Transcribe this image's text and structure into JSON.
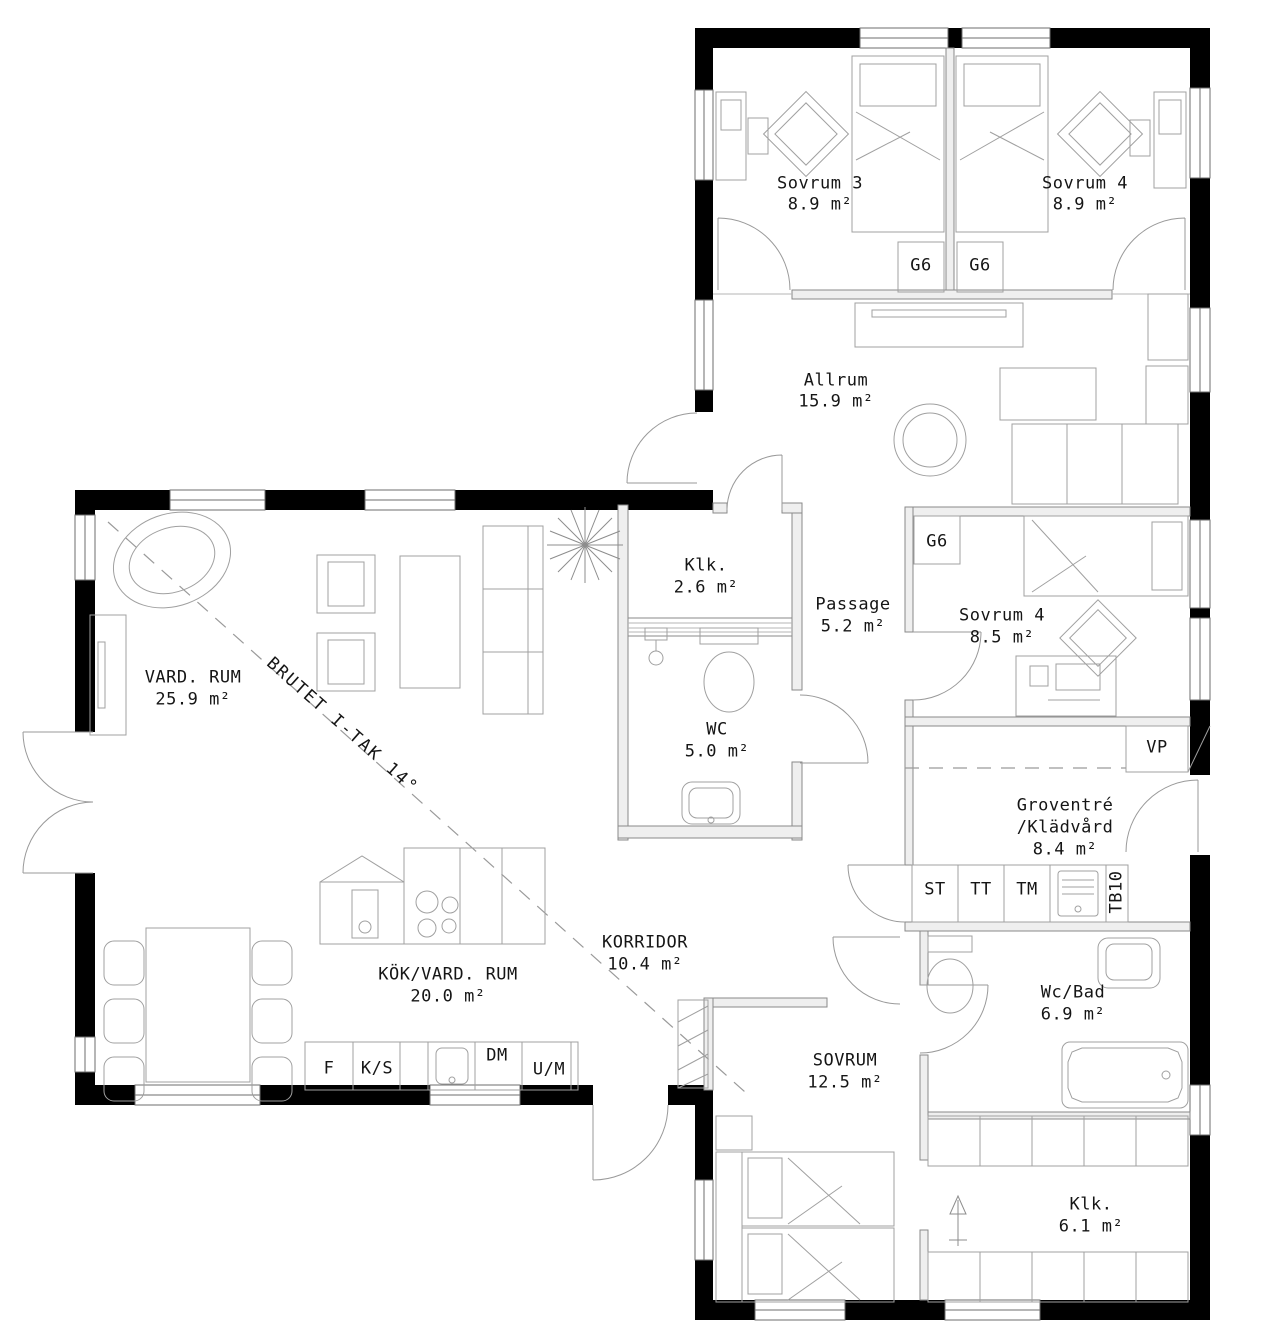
{
  "rooms": {
    "sovrum3": {
      "name": "Sovrum 3",
      "area": "8.9 m²"
    },
    "sovrum4_top": {
      "name": "Sovrum 4",
      "area": "8.9 m²"
    },
    "allrum": {
      "name": "Allrum",
      "area": "15.9 m²"
    },
    "klk_top": {
      "name": "Klk.",
      "area": "2.6 m²"
    },
    "passage": {
      "name": "Passage",
      "area": "5.2 m²"
    },
    "sovrum4_mid": {
      "name": "Sovrum 4",
      "area": "8.5 m²"
    },
    "vardrum": {
      "name": "VARD. RUM",
      "area": "25.9 m²"
    },
    "wc": {
      "name": "WC",
      "area": "5.0 m²"
    },
    "groventre": {
      "name": "Groventré",
      "name2": "/Klädvård",
      "area": "8.4 m²"
    },
    "korridor": {
      "name": "KORRIDOR",
      "area": "10.4 m²"
    },
    "kok": {
      "name": "KÖK/VARD. RUM",
      "area": "20.0 m²"
    },
    "sovrum_master": {
      "name": "SOVRUM",
      "area": "12.5 m²"
    },
    "wcbad": {
      "name": "Wc/Bad",
      "area": "6.9 m²"
    },
    "klk_bottom": {
      "name": "Klk.",
      "area": "6.1 m²"
    }
  },
  "fixtures": {
    "g6_1": "G6",
    "g6_2": "G6",
    "g6_3": "G6",
    "vp": "VP",
    "st": "ST",
    "tt": "TT",
    "tm": "TM",
    "tb10": "TB10",
    "f": "F",
    "ks": "K/S",
    "dm": "DM",
    "um": "U/M"
  },
  "annotations": {
    "roof_break": "BRUTET I-TAK 14°"
  },
  "colors": {
    "wall": "#000000",
    "interior_wall": "#8a8a8a",
    "furniture": "#9f9f9f",
    "text": "#151515"
  }
}
